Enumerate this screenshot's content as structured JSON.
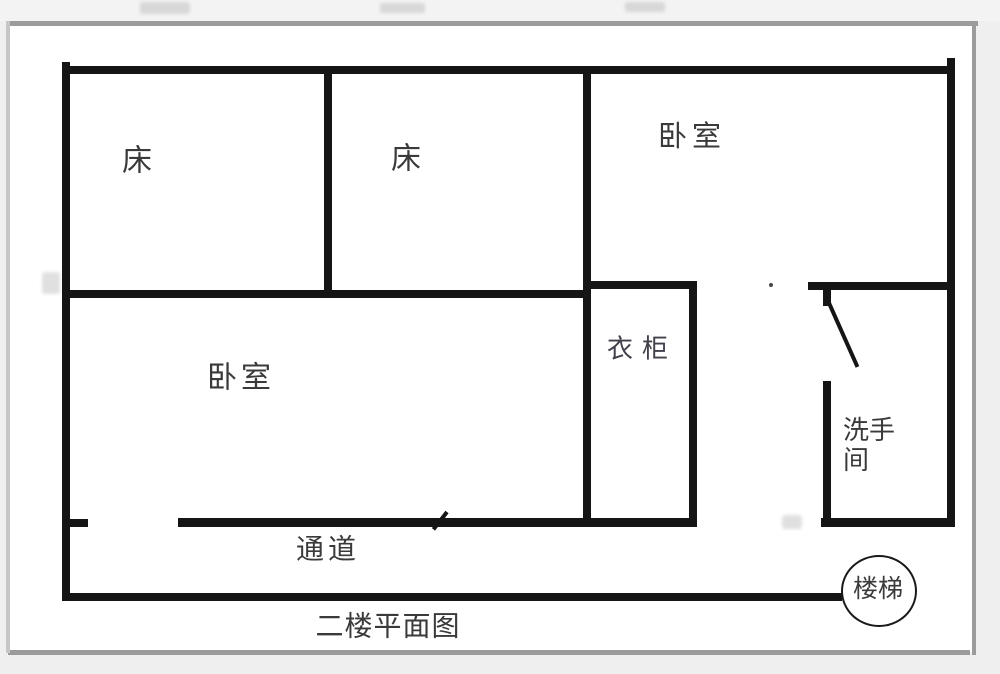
{
  "caption": "二楼平面图",
  "rooms": {
    "bed_left": {
      "label": "床"
    },
    "bed_mid": {
      "label": "床"
    },
    "bedroom_top_right": {
      "label": "卧室"
    },
    "bedroom_main": {
      "label": "卧室"
    },
    "wardrobe": {
      "label": "衣柜"
    },
    "bathroom": {
      "label_line1": "洗手",
      "label_line2": "间"
    },
    "corridor": {
      "label": "通道"
    },
    "stairs": {
      "label": "楼梯"
    }
  },
  "colors": {
    "wall": "#151515",
    "text": "#3a3a3a",
    "page_bg": "#ffffff",
    "outer_bg": "#efefef",
    "frame": "#9b9b9b"
  }
}
